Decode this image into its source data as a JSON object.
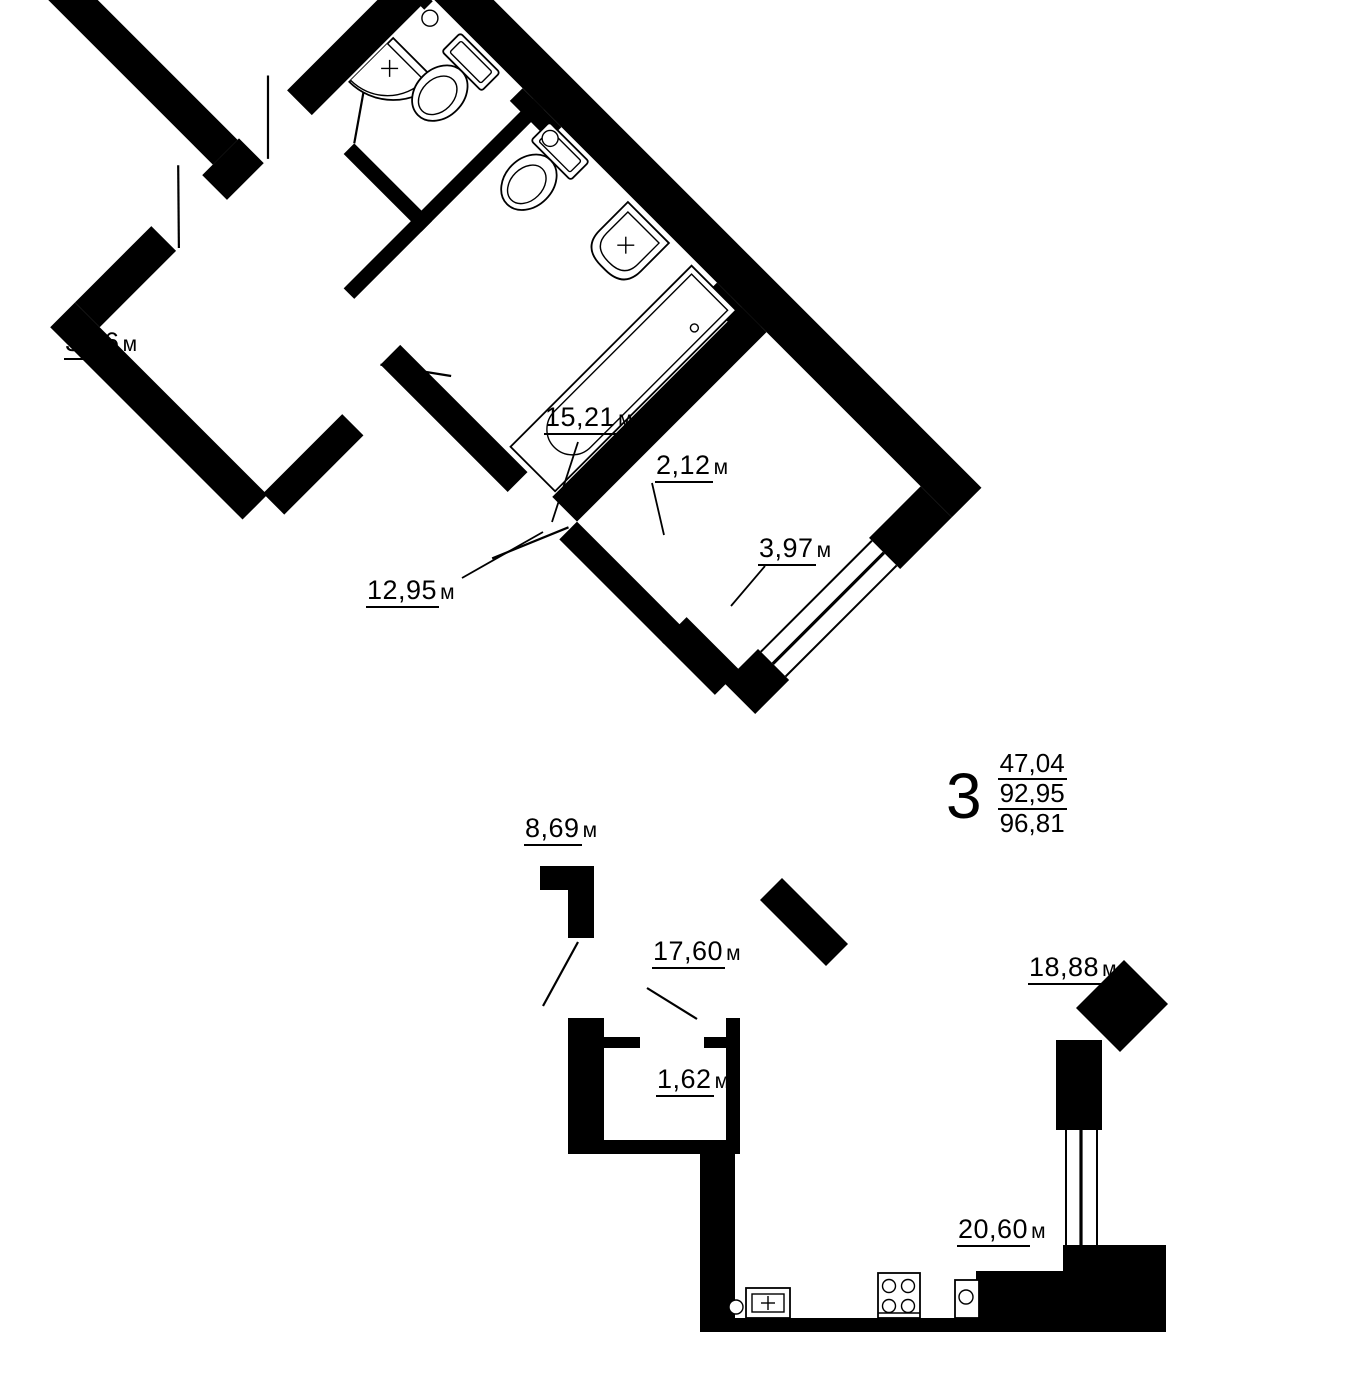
{
  "plan": {
    "unit_summary": {
      "rooms_count": "3",
      "living_area": "47,04",
      "apartment_area": "92,95",
      "total_area": "96,81"
    },
    "rooms": [
      {
        "id": "balcony",
        "area": "3,86",
        "unit": "м"
      },
      {
        "id": "bedroom-1",
        "area": "15,21",
        "unit": "м"
      },
      {
        "id": "wc",
        "area": "2,12",
        "unit": "м"
      },
      {
        "id": "bathroom",
        "area": "3,97",
        "unit": "м"
      },
      {
        "id": "bedroom-2",
        "area": "12,95",
        "unit": "м"
      },
      {
        "id": "hallway",
        "area": "8,69",
        "unit": "м"
      },
      {
        "id": "corridor",
        "area": "17,60",
        "unit": "м"
      },
      {
        "id": "storage",
        "area": "1,62",
        "unit": "м"
      },
      {
        "id": "living-room",
        "area": "18,88",
        "unit": "м"
      },
      {
        "id": "kitchen",
        "area": "20,60",
        "unit": "м"
      }
    ],
    "fixtures": [
      "corner-sink",
      "toilet",
      "toilet",
      "washbasin",
      "bathtub",
      "kitchen-sink",
      "stove",
      "oven"
    ]
  }
}
